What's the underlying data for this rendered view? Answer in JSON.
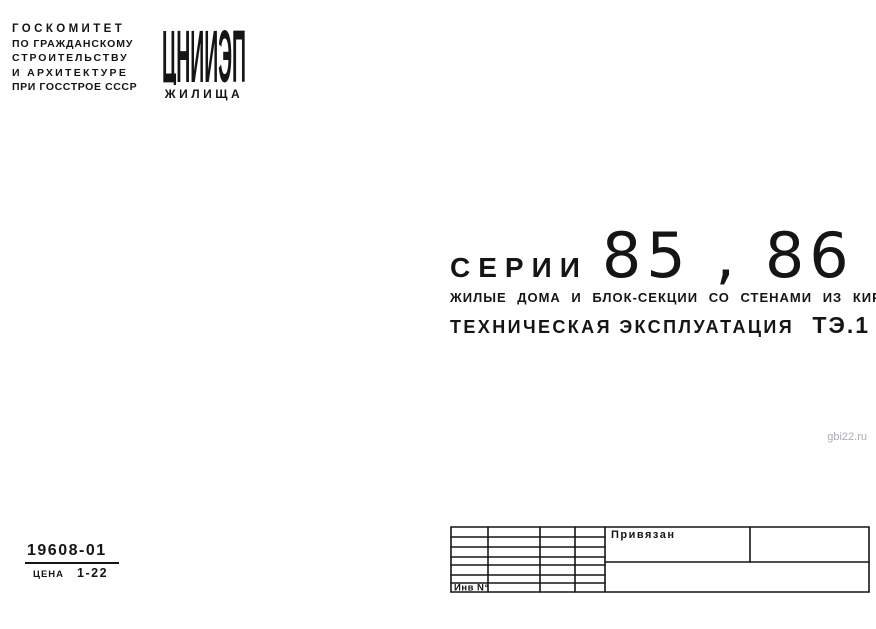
{
  "header": {
    "committee_lines": [
      "ГОСКОМИТЕТ",
      "ПО ГРАЖДАНСКОМУ",
      "СТРОИТЕЛЬСТВУ",
      "И АРХИТЕКТУРЕ",
      "ПРИ ГОССТРОЕ СССР"
    ],
    "logo": {
      "acronym": "ЦНИИЭП",
      "subtitle": "ЖИЛИЩА"
    }
  },
  "title": {
    "series_label": "СЕРИИ",
    "series_numbers": "85 , 86",
    "subtitle": "ЖИЛЫЕ ДОМА И БЛОК-СЕКЦИИ СО СТЕНАМИ ИЗ КИРПИЧА",
    "doc_type": "ТЕХНИЧЕСКАЯ ЭКСПЛУАТАЦИЯ",
    "doc_code": "ТЭ.1"
  },
  "watermark": "gbi22.ru",
  "footer": {
    "catalog_number": "19608-01",
    "price_label": "ЦЕНА",
    "price_value": "1-22"
  },
  "title_block": {
    "assigned_label": "Привязан",
    "inventory_label": "Инв N°"
  },
  "colors": {
    "ink": "#151515",
    "paper": "#ffffff",
    "watermark": "#aaadb2"
  }
}
